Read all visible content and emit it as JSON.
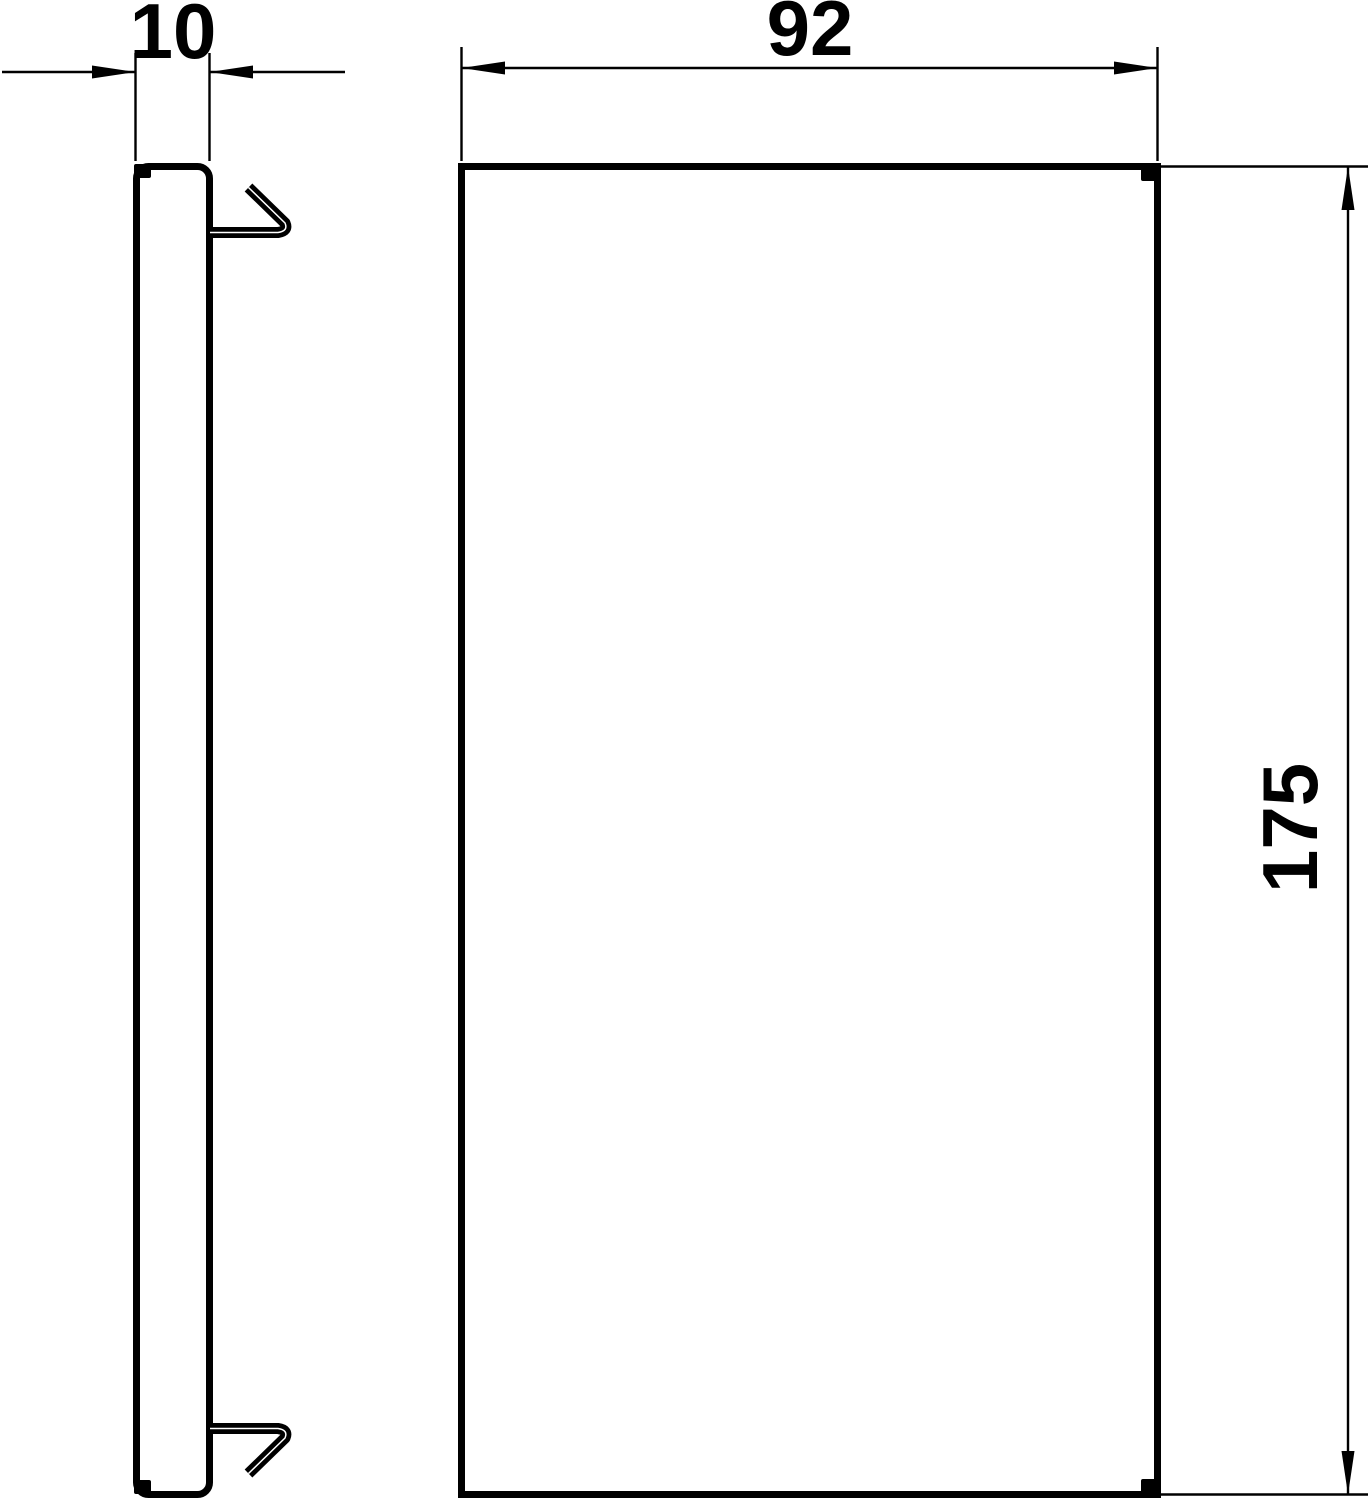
{
  "drawing": {
    "dimensions": {
      "depth": {
        "label": "10"
      },
      "width": {
        "label": "92"
      },
      "height": {
        "label": "175"
      }
    },
    "colors": {
      "line": "#000000",
      "background": "#ffffff"
    }
  }
}
